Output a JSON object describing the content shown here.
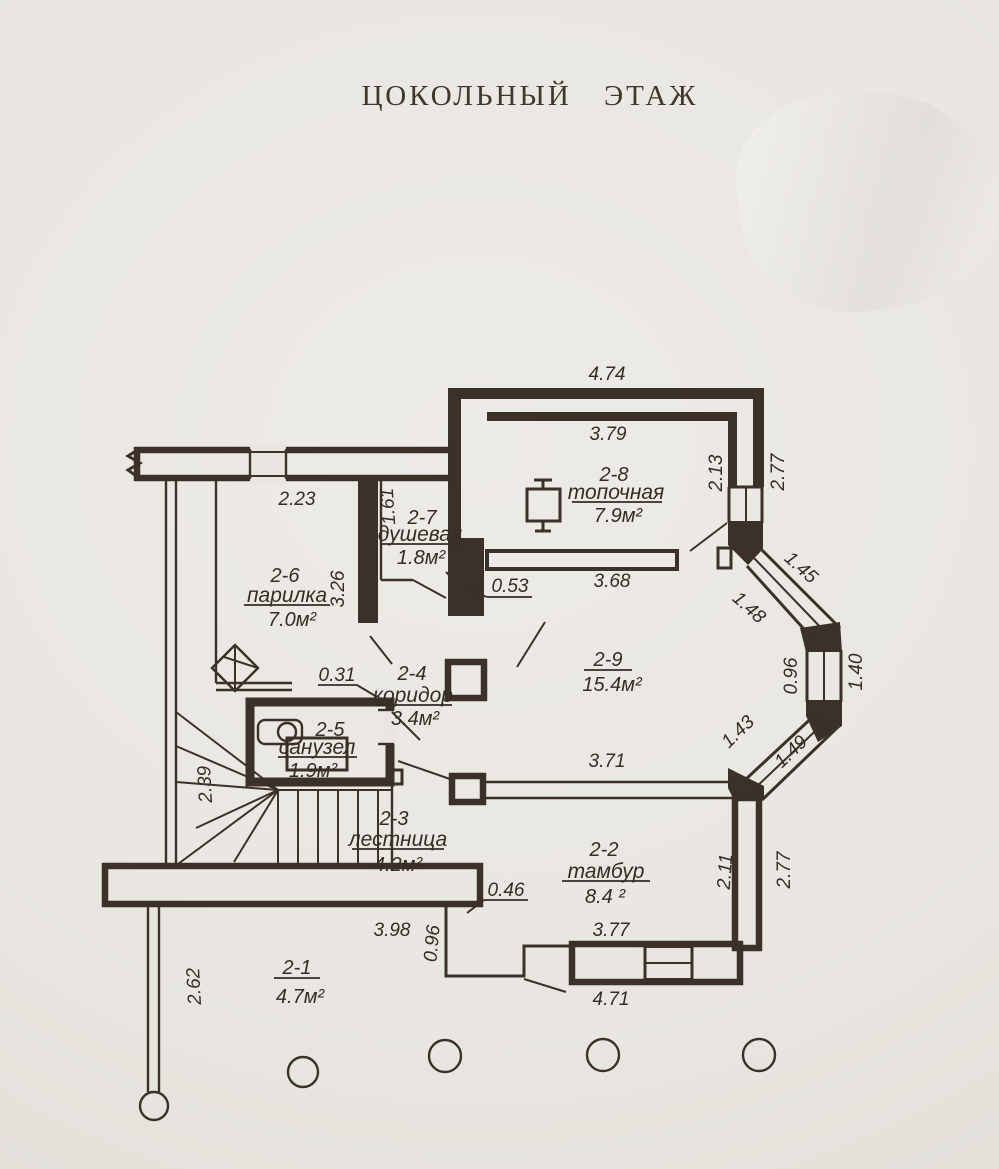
{
  "title": "ЦОКОЛЬНЫЙ ЭТАЖ",
  "ink_color": "#3b3129",
  "paper_color": "#e9e6e1",
  "rooms": [
    {
      "id": "2-1",
      "name": "",
      "area": "4.7м²"
    },
    {
      "id": "2-2",
      "name": "тамбур",
      "area": "8.4 ²"
    },
    {
      "id": "2-3",
      "name": "лестница",
      "area": "4.2м²"
    },
    {
      "id": "2-4",
      "name": "коридор",
      "area": "3.4м²"
    },
    {
      "id": "2-5",
      "name": "санузел",
      "area": "1.9м²"
    },
    {
      "id": "2-6",
      "name": "парилка",
      "area": "7.0м²"
    },
    {
      "id": "2-7",
      "name": "душевая",
      "area": "1.8м²"
    },
    {
      "id": "2-8",
      "name": "топочная",
      "area": "7.9м²"
    },
    {
      "id": "2-9",
      "name": "",
      "area": "15.4м²"
    }
  ],
  "dims": {
    "outer_top": "4.74",
    "boiler_room_top": "3.79",
    "right_window_inner": "2.13",
    "right_window_outer": "2.77",
    "parilka_top": "2.23",
    "dush_height": "1.61",
    "parilka_height": "3.26",
    "wall_stub_053": "0.53",
    "partition_368": "3.68",
    "bay_top_outer": "1.45",
    "bay_top_inner": "1.48",
    "bay_mid_inner": "0.96",
    "bay_mid_outer": "1.40",
    "bay_bottom_inner": "1.43",
    "bay_bottom_outer": "1.49",
    "stub_031": "0.31",
    "hall_bottom": "3.71",
    "stairs_left": "2.39",
    "tambur_right_inner": "2.11",
    "tambur_right_outer": "2.77",
    "stub_046": "0.46",
    "porch_top": "3.98",
    "porch_step": "0.96",
    "tambur_bottom_inner": "3.77",
    "tambur_bottom_outer": "4.71",
    "porch_left": "2.62"
  }
}
